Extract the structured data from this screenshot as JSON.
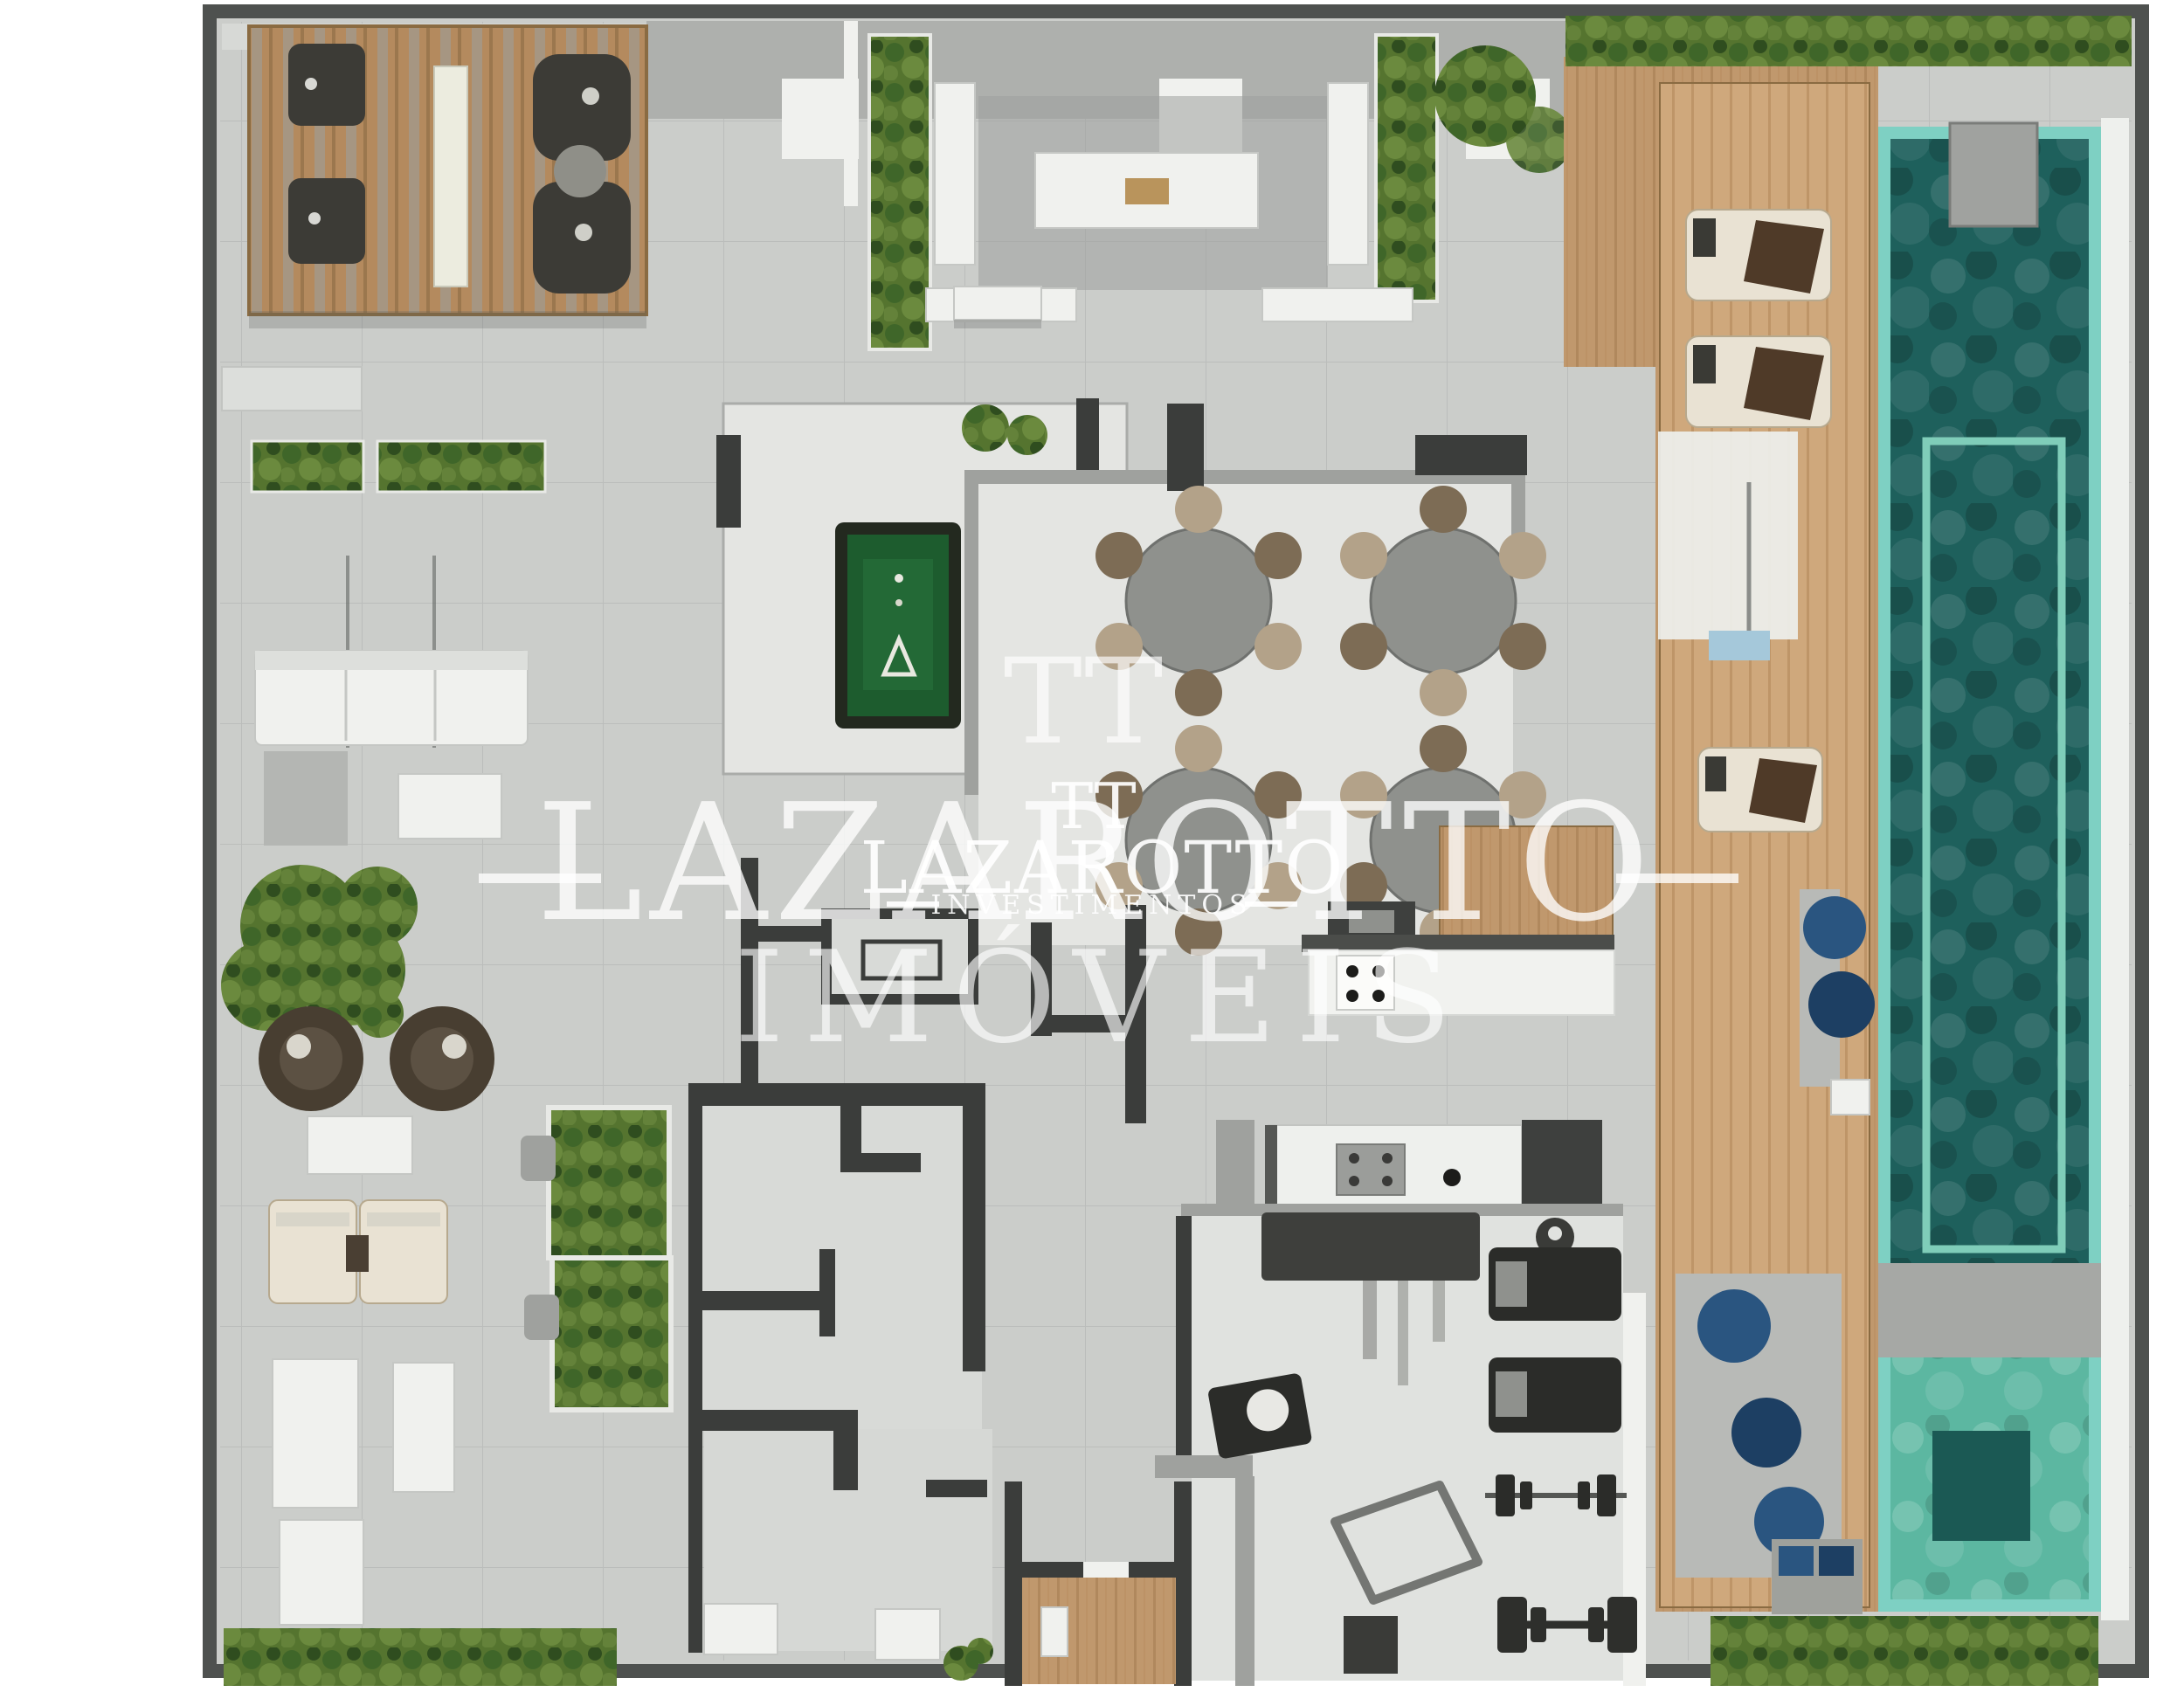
{
  "watermark": {
    "logo_large": "TT",
    "logo_small": "TT",
    "brand_large": "LAZAROTTO",
    "brand_small": "LAZAROTTO",
    "subtitle_small": "INVESTIMENTOS",
    "brand_footer": "IMÓVEIS"
  },
  "theme": {
    "frame": "#4e514f",
    "concrete": "#cbcdca",
    "room": "#e4e5e2",
    "wall-dark": "#3b3d3b",
    "wall-gray": "#9fa19e",
    "wood": "#c0986d",
    "wood-light": "#cfa87c",
    "hedge": "#55742f",
    "pool-rim": "#7ed0c3",
    "pool-water": "#1e605c",
    "pool-water-light": "#5cb7a1",
    "felt": "#1d5c2e",
    "white-furn": "#f0f1ee",
    "wm": "rgba(255,255,255,0.78)"
  }
}
